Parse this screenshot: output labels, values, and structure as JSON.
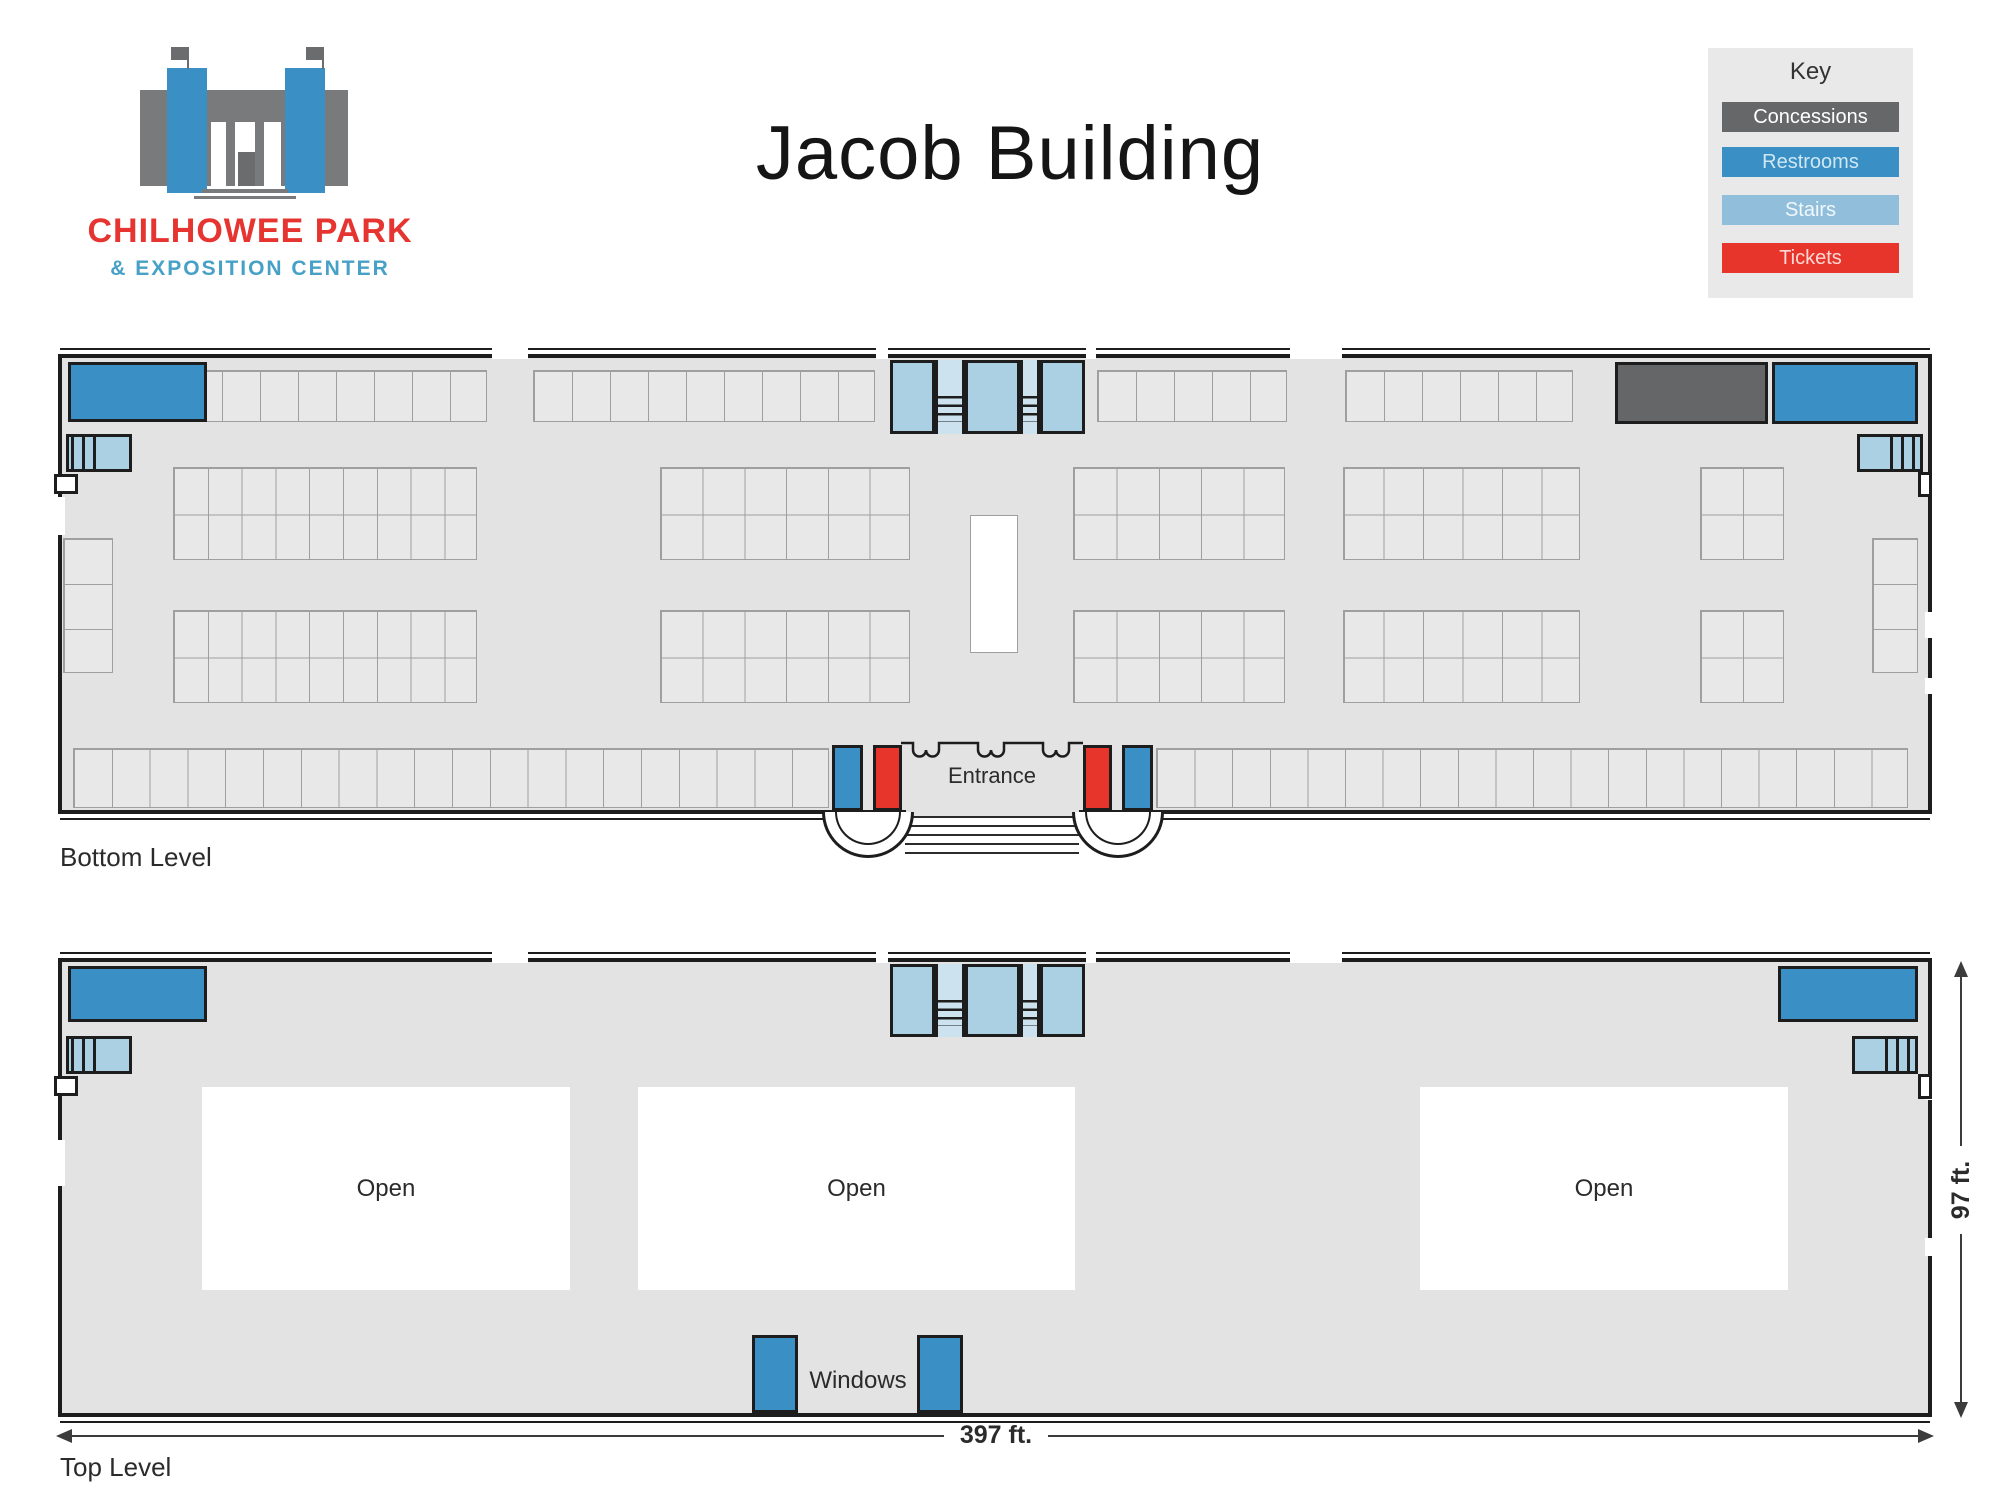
{
  "brand": {
    "name_top": "CHILHOWEE PARK",
    "name_bottom": "& EXPOSITION CENTER"
  },
  "title": "Jacob Building",
  "key": {
    "title": "Key",
    "items": [
      {
        "label": "Concessions",
        "color": "#666769",
        "text": "#ffffff"
      },
      {
        "label": "Restrooms",
        "color": "#3a8fc4",
        "text": "#cfe7f3"
      },
      {
        "label": "Stairs",
        "color": "#90bedb",
        "text": "#f1f8fb"
      },
      {
        "label": "Tickets",
        "color": "#e8352b",
        "text": "#ffd8d5"
      }
    ]
  },
  "colors": {
    "floor": "#e3e3e3",
    "wall": "#1d1d1d",
    "booth_fill": "#e8e8e8",
    "booth_line": "#9f9f9f",
    "restroom": "#3a8fc4",
    "stairs": "#abcfe3",
    "stairs_light": "#cde2ef",
    "ticket": "#e8352b",
    "concession": "#656668",
    "open": "#ffffff",
    "dim_line": "#3c3c3c",
    "label": "#2b2b2b",
    "brand_red": "#e63530",
    "brand_blue": "#47a1c7",
    "logo_gray": "#787a7c",
    "logo_dark": "#6a6c6e",
    "title_color": "#151515",
    "key_bg": "#e9e9e9"
  },
  "levels": [
    {
      "name": "bottom-level",
      "label": "Bottom Level",
      "label_x": 60,
      "label_y": 842,
      "x": 58,
      "y": 354,
      "w": 1874,
      "h": 460,
      "rooms": [
        {
          "t": "restroom",
          "x": 68,
          "y": 362,
          "w": 139,
          "h": 60
        },
        {
          "t": "concession",
          "x": 1615,
          "y": 362,
          "w": 153,
          "h": 62
        },
        {
          "t": "restroom",
          "x": 1772,
          "y": 362,
          "w": 146,
          "h": 62
        },
        {
          "t": "restroom",
          "x": 832,
          "y": 745,
          "w": 31,
          "h": 66
        },
        {
          "t": "ticket",
          "x": 873,
          "y": 745,
          "w": 29,
          "h": 66
        },
        {
          "t": "ticket",
          "x": 1083,
          "y": 745,
          "w": 29,
          "h": 66
        },
        {
          "t": "restroom",
          "x": 1122,
          "y": 745,
          "w": 31,
          "h": 66
        }
      ],
      "corner_stairs": [
        {
          "x": 66,
          "y": 434,
          "w": 66,
          "h": 38,
          "dir": "left"
        },
        {
          "x": 1857,
          "y": 434,
          "w": 66,
          "h": 38,
          "dir": "right"
        }
      ],
      "center_stairs": {
        "x": 890,
        "y": 360,
        "w": 195,
        "h": 74
      },
      "stage": {
        "x": 970,
        "y": 515,
        "w": 48,
        "h": 138
      },
      "booths": [
        {
          "x": 183,
          "y": 370,
          "cols": 8,
          "rows": 1,
          "cw": 38,
          "ch": 52
        },
        {
          "x": 533,
          "y": 370,
          "cols": 9,
          "rows": 1,
          "cw": 38,
          "ch": 52
        },
        {
          "x": 1097,
          "y": 370,
          "cols": 5,
          "rows": 1,
          "cw": 38,
          "ch": 52
        },
        {
          "x": 1345,
          "y": 370,
          "cols": 6,
          "rows": 1,
          "cw": 38,
          "ch": 52
        },
        {
          "x": 173,
          "y": 467,
          "cols": 9,
          "rows": 2,
          "cw": 33.8,
          "ch": 46.5
        },
        {
          "x": 660,
          "y": 467,
          "cols": 6,
          "rows": 2,
          "cw": 41.7,
          "ch": 46.5
        },
        {
          "x": 1073,
          "y": 467,
          "cols": 5,
          "rows": 2,
          "cw": 42.4,
          "ch": 46.5
        },
        {
          "x": 1343,
          "y": 467,
          "cols": 6,
          "rows": 2,
          "cw": 39.5,
          "ch": 46.5
        },
        {
          "x": 1700,
          "y": 467,
          "cols": 2,
          "rows": 2,
          "cw": 42,
          "ch": 46.5
        },
        {
          "x": 173,
          "y": 610,
          "cols": 9,
          "rows": 2,
          "cw": 33.8,
          "ch": 46.5
        },
        {
          "x": 660,
          "y": 610,
          "cols": 6,
          "rows": 2,
          "cw": 41.7,
          "ch": 46.5
        },
        {
          "x": 1073,
          "y": 610,
          "cols": 5,
          "rows": 2,
          "cw": 42.4,
          "ch": 46.5
        },
        {
          "x": 1343,
          "y": 610,
          "cols": 6,
          "rows": 2,
          "cw": 39.5,
          "ch": 46.5
        },
        {
          "x": 1700,
          "y": 610,
          "cols": 2,
          "rows": 2,
          "cw": 42,
          "ch": 46.5
        },
        {
          "x": 63,
          "y": 538,
          "cols": 1,
          "rows": 3,
          "cw": 50,
          "ch": 45
        },
        {
          "x": 1872,
          "y": 538,
          "cols": 1,
          "rows": 3,
          "cw": 46,
          "ch": 45
        },
        {
          "x": 73,
          "y": 748,
          "cols": 20,
          "rows": 1,
          "cw": 37.8,
          "ch": 60
        },
        {
          "x": 1156,
          "y": 748,
          "cols": 20,
          "rows": 1,
          "cw": 37.6,
          "ch": 60
        }
      ],
      "gaps_top": [
        {
          "x": 492,
          "w": 36
        },
        {
          "x": 876,
          "w": 12
        },
        {
          "x": 1086,
          "w": 10
        },
        {
          "x": 1290,
          "w": 52
        }
      ],
      "gaps_left": [
        {
          "y": 497,
          "h": 38
        }
      ],
      "gaps_right": [
        {
          "y": 612,
          "h": 26
        },
        {
          "y": 678,
          "h": 16
        }
      ],
      "nibs": [
        {
          "x": 54,
          "y": 474,
          "w": 24,
          "h": 20
        },
        {
          "x": 1918,
          "y": 472,
          "w": 14,
          "h": 25
        }
      ],
      "entrance": {
        "label": "Entrance",
        "gap_x": 906,
        "gap_w": 173,
        "steps_x": 905,
        "steps_y": 816,
        "steps_w": 174,
        "steps_h": 44,
        "planter_lx": 822,
        "planter_rx": 1072,
        "planter_y": 812,
        "squiggle_x": 899,
        "squiggle_y": 733,
        "label_cx": 992,
        "label_cy": 776
      }
    },
    {
      "name": "top-level",
      "label": "Top Level",
      "label_x": 60,
      "label_y": 1452,
      "x": 58,
      "y": 958,
      "w": 1874,
      "h": 459,
      "rooms": [
        {
          "t": "restroom",
          "x": 68,
          "y": 966,
          "w": 139,
          "h": 56
        },
        {
          "t": "restroom",
          "x": 1778,
          "y": 966,
          "w": 140,
          "h": 56
        },
        {
          "t": "restroom",
          "x": 752,
          "y": 1335,
          "w": 46,
          "h": 78
        },
        {
          "t": "restroom",
          "x": 917,
          "y": 1335,
          "w": 46,
          "h": 78
        }
      ],
      "corner_stairs": [
        {
          "x": 66,
          "y": 1036,
          "w": 66,
          "h": 38,
          "dir": "left"
        },
        {
          "x": 1852,
          "y": 1036,
          "w": 66,
          "h": 38,
          "dir": "right"
        }
      ],
      "center_stairs": {
        "x": 890,
        "y": 964,
        "w": 195,
        "h": 73
      },
      "open_label": "Open",
      "open_areas": [
        {
          "x": 202,
          "y": 1087,
          "w": 368,
          "h": 203
        },
        {
          "x": 638,
          "y": 1087,
          "w": 437,
          "h": 203
        },
        {
          "x": 1420,
          "y": 1087,
          "w": 368,
          "h": 203
        }
      ],
      "windows": {
        "label": "Windows",
        "cx": 858,
        "cy": 1381
      },
      "gaps_top": [
        {
          "x": 492,
          "w": 36
        },
        {
          "x": 876,
          "w": 12
        },
        {
          "x": 1086,
          "w": 10
        },
        {
          "x": 1290,
          "w": 52
        }
      ],
      "gaps_left": [
        {
          "y": 1140,
          "h": 46
        }
      ],
      "gaps_right": [
        {
          "y": 1082,
          "h": 18
        },
        {
          "y": 1238,
          "h": 18
        }
      ],
      "nibs": [
        {
          "x": 54,
          "y": 1076,
          "w": 24,
          "h": 20
        },
        {
          "x": 1918,
          "y": 1074,
          "w": 14,
          "h": 25
        }
      ]
    }
  ],
  "dims": {
    "width": {
      "label": "397 ft.",
      "y": 1435,
      "x1": 58,
      "x2": 1932,
      "gap1": 944,
      "gap2": 1048
    },
    "height": {
      "label": "97 ft.",
      "x": 1960,
      "y1": 963,
      "y2": 1416,
      "gap1": 1146,
      "gap2": 1234
    }
  }
}
